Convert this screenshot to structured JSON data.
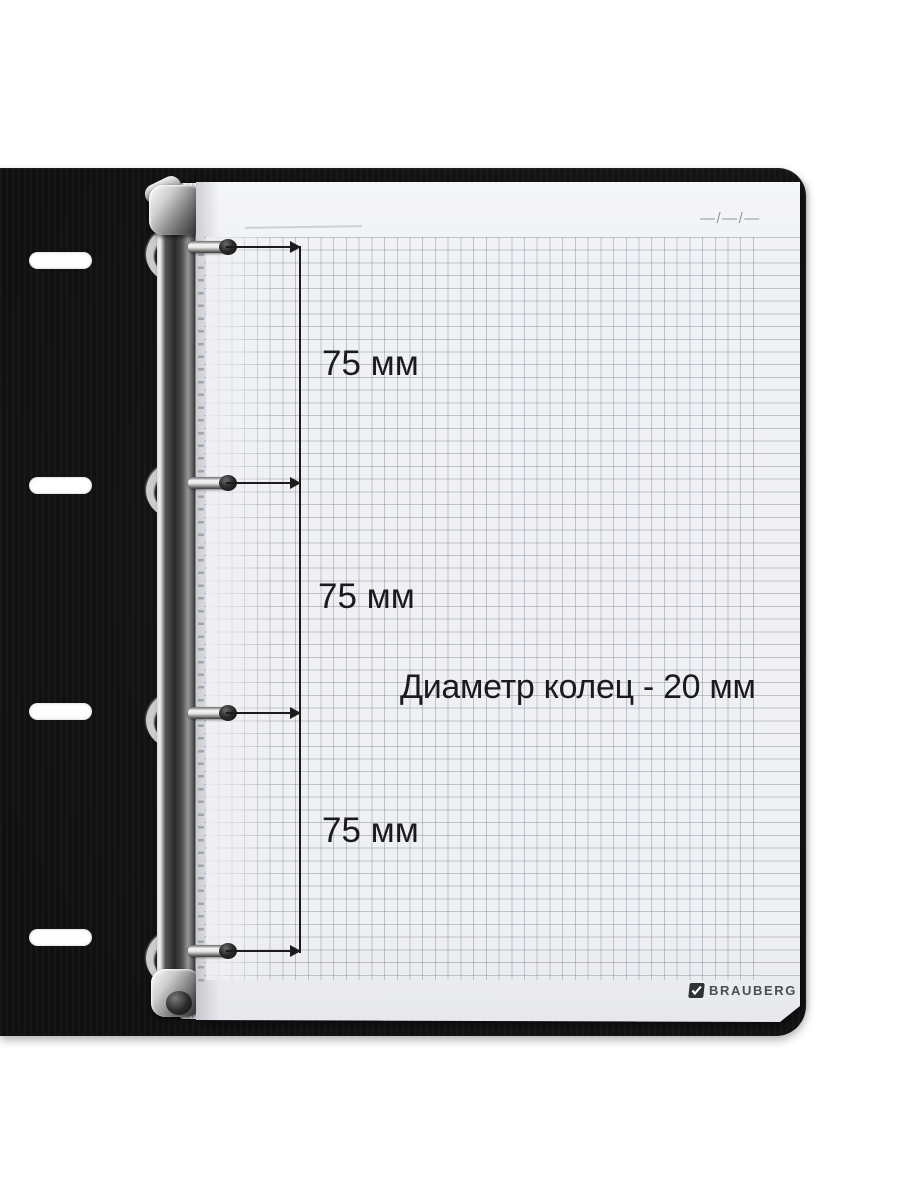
{
  "annotations": {
    "spacing_labels": [
      "75 мм",
      "75 мм",
      "75 мм"
    ],
    "diameter_label": "Диаметр колец - 20 мм"
  },
  "page": {
    "date_placeholder": "—/—/—",
    "brand": {
      "name": "BRAUBERG",
      "registered_mark": "®",
      "logo_icon": "checkmark-badge-icon"
    }
  },
  "hardware": {
    "ring_count": 4,
    "cover_slot_count": 4
  },
  "colors": {
    "cover_black": "#131313",
    "paper": "#f0f1f5",
    "grid_line": "#7b8294",
    "annotation_ink": "#1b1b1b",
    "metal_light": "#f5f5f5",
    "metal_dark": "#2e2e2e"
  }
}
